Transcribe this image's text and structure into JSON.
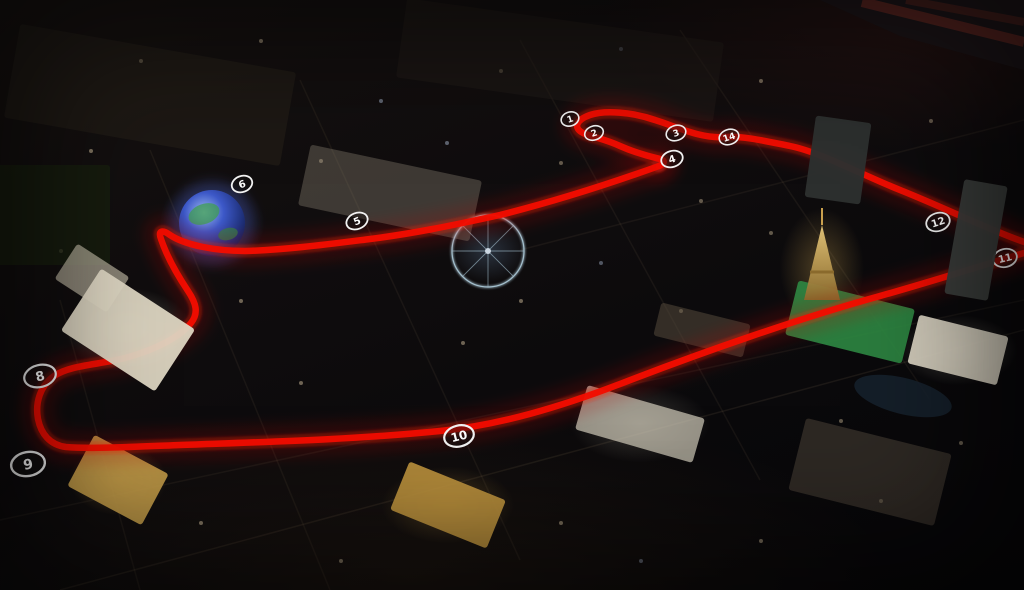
{
  "map": {
    "description": "Night aerial 3D render of the Las Vegas Strip with a red Formula 1 street-circuit route overlaid and numbered turn markers",
    "width": 1024,
    "height": 590
  },
  "track": {
    "color": "#f20d00",
    "glow_color": "#ff2012",
    "haze_color": "#c01008",
    "segments": [
      {
        "name": "koval-sphere-strip-section",
        "d": "M659,166 C620,180 560,200 500,215 C450,226 410,234 370,239 C330,244 285,250 245,251 C215,251 185,245 170,235 C162,229 158,231 161,239 C166,254 176,273 188,291 C196,303 199,313 191,323 C180,337 155,350 125,358 C98,365 70,365 54,376 C40,386 35,403 38,419 C41,434 50,445 66,447 C90,449 130,447 180,445 C260,442 350,440 440,431 C500,425 560,407 620,384 C700,353 800,318 880,296 C930,282 980,266 1024,253"
      },
      {
        "name": "harmon-return-and-start-complex",
        "d": "M1024,242 C985,228 945,208 900,190 C860,174 820,152 790,146 C765,141 745,136 725,137 C700,139 675,126 655,120 C632,112 605,110 590,115 C576,120 573,128 583,133 C592,137 605,139 620,146 C638,154 652,157 660,159 C666,161 664,164 659,166"
      }
    ]
  },
  "turn_markers": {
    "style": {
      "ring_color": "#f2f2f2",
      "fill": "rgba(20,18,18,0.45)",
      "text_color": "#ffffff"
    },
    "items": [
      {
        "label": "1",
        "x": 570,
        "y": 119,
        "rx": 9,
        "ry": 7,
        "rot": -18,
        "font": 9,
        "sw": 1.6
      },
      {
        "label": "2",
        "x": 594,
        "y": 133,
        "rx": 9.5,
        "ry": 7,
        "rot": -18,
        "font": 9,
        "sw": 1.6
      },
      {
        "label": "3",
        "x": 676,
        "y": 133,
        "rx": 10,
        "ry": 7.5,
        "rot": -18,
        "font": 9,
        "sw": 1.6
      },
      {
        "label": "4",
        "x": 672,
        "y": 159,
        "rx": 11,
        "ry": 8,
        "rot": -18,
        "font": 10,
        "sw": 1.8
      },
      {
        "label": "5",
        "x": 357,
        "y": 221,
        "rx": 11,
        "ry": 8,
        "rot": -22,
        "font": 10,
        "sw": 1.8
      },
      {
        "label": "6",
        "x": 242,
        "y": 184,
        "rx": 10.5,
        "ry": 8,
        "rot": -20,
        "font": 10,
        "sw": 1.8
      },
      {
        "label": "8",
        "x": 40,
        "y": 376,
        "rx": 16,
        "ry": 11,
        "rot": -14,
        "font": 13,
        "sw": 2.2
      },
      {
        "label": "9",
        "x": 28,
        "y": 464,
        "rx": 17,
        "ry": 12,
        "rot": -10,
        "font": 14,
        "sw": 2.4
      },
      {
        "label": "10",
        "x": 459,
        "y": 436,
        "rx": 15,
        "ry": 10.5,
        "rot": -14,
        "font": 12,
        "sw": 2.2
      },
      {
        "label": "11",
        "x": 1005,
        "y": 258,
        "rx": 12,
        "ry": 9,
        "rot": -14,
        "font": 10,
        "sw": 1.8
      },
      {
        "label": "12",
        "x": 938,
        "y": 222,
        "rx": 12,
        "ry": 9,
        "rot": -18,
        "font": 10,
        "sw": 1.8
      },
      {
        "label": "14",
        "x": 729,
        "y": 137,
        "rx": 10,
        "ry": 7.5,
        "rot": -18,
        "font": 9,
        "sw": 1.6
      }
    ]
  },
  "landmarks": [
    {
      "name": "city-blocks-north",
      "cx": 150,
      "cy": 95,
      "w": 280,
      "h": 95,
      "rot": 10,
      "fill": "#262019",
      "opacity": 0.55,
      "shape": "rect",
      "layer": "back"
    },
    {
      "name": "convention-lots",
      "cx": 560,
      "cy": 60,
      "w": 320,
      "h": 80,
      "rot": 8,
      "fill": "#221c17",
      "opacity": 0.5,
      "shape": "rect",
      "layer": "back"
    },
    {
      "name": "wynn-golf-area",
      "cx": 45,
      "cy": 215,
      "w": 130,
      "h": 100,
      "rot": 0,
      "fill": "#18200f",
      "opacity": 0.75,
      "shape": "rect",
      "layer": "back"
    },
    {
      "name": "sands-expo-roof",
      "cx": 390,
      "cy": 193,
      "w": 175,
      "h": 62,
      "rot": 12,
      "fill": "#857e6f",
      "opacity": 0.4,
      "shape": "rect",
      "layer": "back"
    },
    {
      "name": "palazzo-tower",
      "cx": 92,
      "cy": 278,
      "w": 62,
      "h": 42,
      "rot": 33,
      "fill": "#b8b09c",
      "opacity": 0.7,
      "shape": "rect",
      "layer": "back"
    },
    {
      "name": "treasure-island-hotel",
      "cx": 118,
      "cy": 480,
      "w": 84,
      "h": 58,
      "rot": 28,
      "fill": "#c79f49",
      "opacity": 0.9,
      "shape": "rect",
      "layer": "back"
    },
    {
      "name": "mirage-hotel",
      "cx": 448,
      "cy": 505,
      "w": 104,
      "h": 52,
      "rot": 22,
      "fill": "#c0953e",
      "opacity": 0.9,
      "shape": "rect",
      "layer": "back"
    },
    {
      "name": "caesars-palace",
      "cx": 640,
      "cy": 424,
      "w": 122,
      "h": 46,
      "rot": 16,
      "fill": "#d2ccba",
      "opacity": 0.7,
      "shape": "rect",
      "layer": "back"
    },
    {
      "name": "flamingo-linq-block",
      "cx": 702,
      "cy": 330,
      "w": 92,
      "h": 34,
      "rot": 14,
      "fill": "#5c503f",
      "opacity": 0.5,
      "shape": "rect",
      "layer": "back"
    },
    {
      "name": "golf-lawn",
      "cx": 850,
      "cy": 322,
      "w": 120,
      "h": 56,
      "rot": 14,
      "fill": "#2e8843",
      "opacity": 0.9,
      "shape": "rect",
      "layer": "back"
    },
    {
      "name": "bellagio-hotel",
      "cx": 958,
      "cy": 350,
      "w": 92,
      "h": 50,
      "rot": 14,
      "fill": "#dcd6c4",
      "opacity": 0.92,
      "shape": "rect",
      "layer": "back"
    },
    {
      "name": "bellagio-lake",
      "cx": 903,
      "cy": 396,
      "w": 100,
      "h": 36,
      "rot": 14,
      "fill": "#16222e",
      "opacity": 0.85,
      "shape": "ellipse",
      "layer": "back"
    },
    {
      "name": "planet-hollywood-block",
      "cx": 870,
      "cy": 472,
      "w": 150,
      "h": 74,
      "rot": 14,
      "fill": "#463d33",
      "opacity": 0.6,
      "shape": "rect",
      "layer": "back"
    },
    {
      "name": "venetian-hotel",
      "cx": 128,
      "cy": 330,
      "w": 112,
      "h": 74,
      "rot": 33,
      "fill": "#ddd6c2",
      "opacity": 0.95,
      "shape": "rect",
      "layer": "front"
    },
    {
      "name": "cosmopolitan-tower",
      "cx": 976,
      "cy": 240,
      "w": 44,
      "h": 116,
      "rot": 10,
      "fill": "#3a3d3b",
      "opacity": 0.97,
      "shape": "rect",
      "layer": "front"
    },
    {
      "name": "harmon-area-tower",
      "cx": 838,
      "cy": 160,
      "w": 56,
      "h": 82,
      "rot": 8,
      "fill": "#2d312f",
      "opacity": 0.97,
      "shape": "rect",
      "layer": "front"
    }
  ],
  "special_features": {
    "msg-sphere": {
      "cx": 212,
      "cy": 223,
      "r": 33,
      "colors": [
        "#9db8f0",
        "#3c58c8",
        "#1a2a6e",
        "#0c1233"
      ],
      "land_color": "#3f9e52"
    },
    "high-roller-wheel": {
      "cx": 488,
      "cy": 251,
      "r": 36,
      "color": "#bfe0f0"
    },
    "eiffel-tower": {
      "color": "#caa04e"
    },
    "airport-runways": {
      "color": "#6e2a22"
    }
  }
}
